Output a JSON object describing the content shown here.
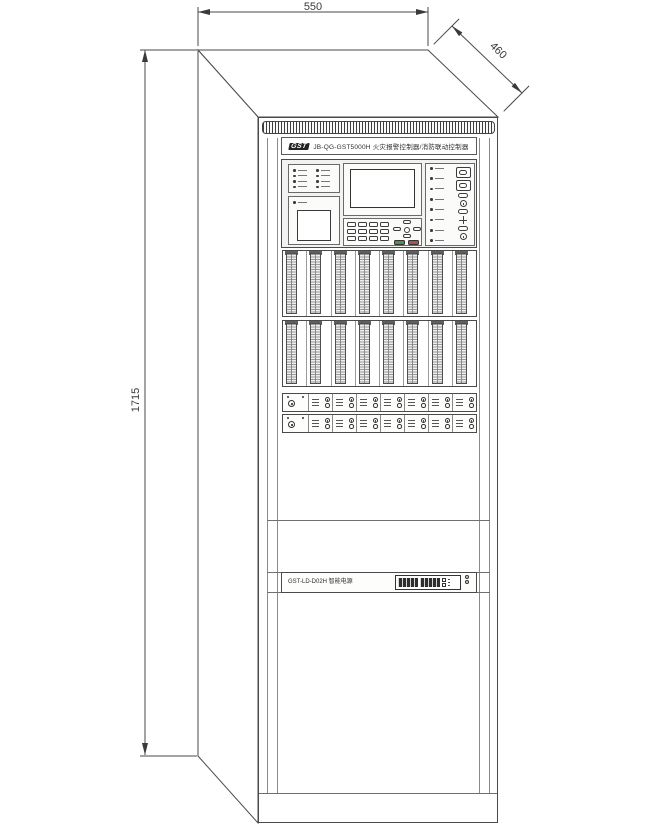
{
  "dimensions": {
    "top_width": "550",
    "depth": "460",
    "height": "1715"
  },
  "nameplate": {
    "brand": "GST",
    "title": "JB-QG-GST5000H 火灾报警控制器/消防联动控制器"
  },
  "power_unit": {
    "label": "GST-LD-D02H 智能电源"
  },
  "counts": {
    "zone_indicator_items": 8,
    "status_indicator_items": 8,
    "keypad_keys": 12,
    "loop_modules_per_bank": 8,
    "relay_modules_per_row": 7
  },
  "colors": {
    "line": "#4a4a4a",
    "panel_fill": "#ffffff",
    "key_green": "#5a8a5a",
    "key_red": "#b05050",
    "display_dark": "#2e2e2e"
  },
  "icons": {
    "brand_logo": "brand-logo-icon",
    "key_switch": "key-switch-icon",
    "navigation_cluster": "navigation-arrows-icon",
    "led_indicator": "led-indicator-icon",
    "seven_segment_display": "seven-segment-display-icon",
    "plus_adjust": "plus-adjust-icon",
    "vent_grille": "vent-grille-icon"
  }
}
